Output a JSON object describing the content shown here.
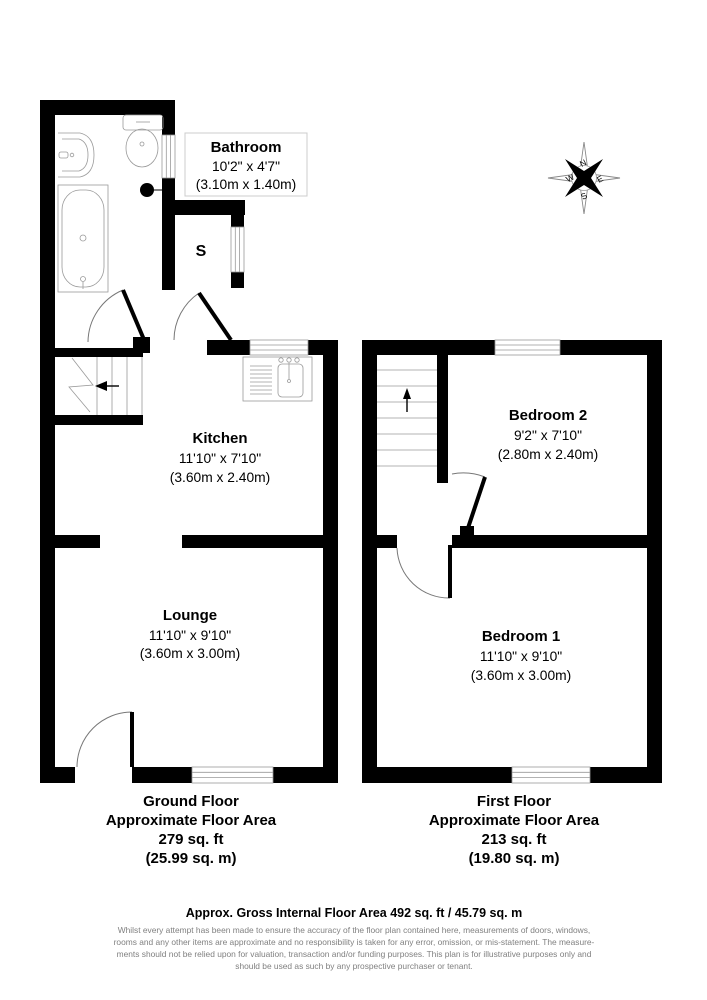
{
  "ground_floor": {
    "rooms": {
      "bathroom": {
        "name": "Bathroom",
        "imperial": "10'2\" x 4'7\"",
        "metric": "(3.10m x 1.40m)"
      },
      "kitchen": {
        "name": "Kitchen",
        "imperial": "11'10\" x 7'10\"",
        "metric": "(3.60m x 2.40m)"
      },
      "lounge": {
        "name": "Lounge",
        "imperial": "11'10\" x 9'10\"",
        "metric": "(3.60m x 3.00m)"
      },
      "store": {
        "name": "S"
      }
    },
    "summary": {
      "floor_name": "Ground Floor",
      "area_label": "Approximate Floor Area",
      "area_sqft": "279 sq. ft",
      "area_sqm": "(25.99 sq. m)"
    }
  },
  "first_floor": {
    "rooms": {
      "bedroom2": {
        "name": "Bedroom 2",
        "imperial": "9'2\" x 7'10\"",
        "metric": "(2.80m x 2.40m)"
      },
      "bedroom1": {
        "name": "Bedroom 1",
        "imperial": "11'10\" x 9'10\"",
        "metric": "(3.60m x 3.00m)"
      }
    },
    "summary": {
      "floor_name": "First Floor",
      "area_label": "Approximate Floor Area",
      "area_sqft": "213 sq. ft",
      "area_sqm": "(19.80 sq. m)"
    }
  },
  "compass": {
    "north": "N",
    "south": "S",
    "east": "E",
    "west": "W"
  },
  "footer": {
    "title": "Approx. Gross Internal Floor Area 492 sq. ft / 45.79 sq. m",
    "disclaimer_lines": [
      "Whilst every attempt has been made to ensure the accuracy of the floor plan contained here, measurements of doors, windows,",
      "rooms and any other items are approximate and no responsibility is taken for any error, omission, or mis-statement. The measure-",
      "ments should not be relied upon for valuation, transaction and/or funding purposes. This plan is for illustrative purposes only and",
      "should be used as such by any prospective purchaser or tenant."
    ]
  },
  "colors": {
    "wall": "#000000",
    "fixture_outline": "#9a9a9a",
    "label_box_border": "#cccccc",
    "disclaimer_text": "#808080",
    "background": "#ffffff"
  }
}
